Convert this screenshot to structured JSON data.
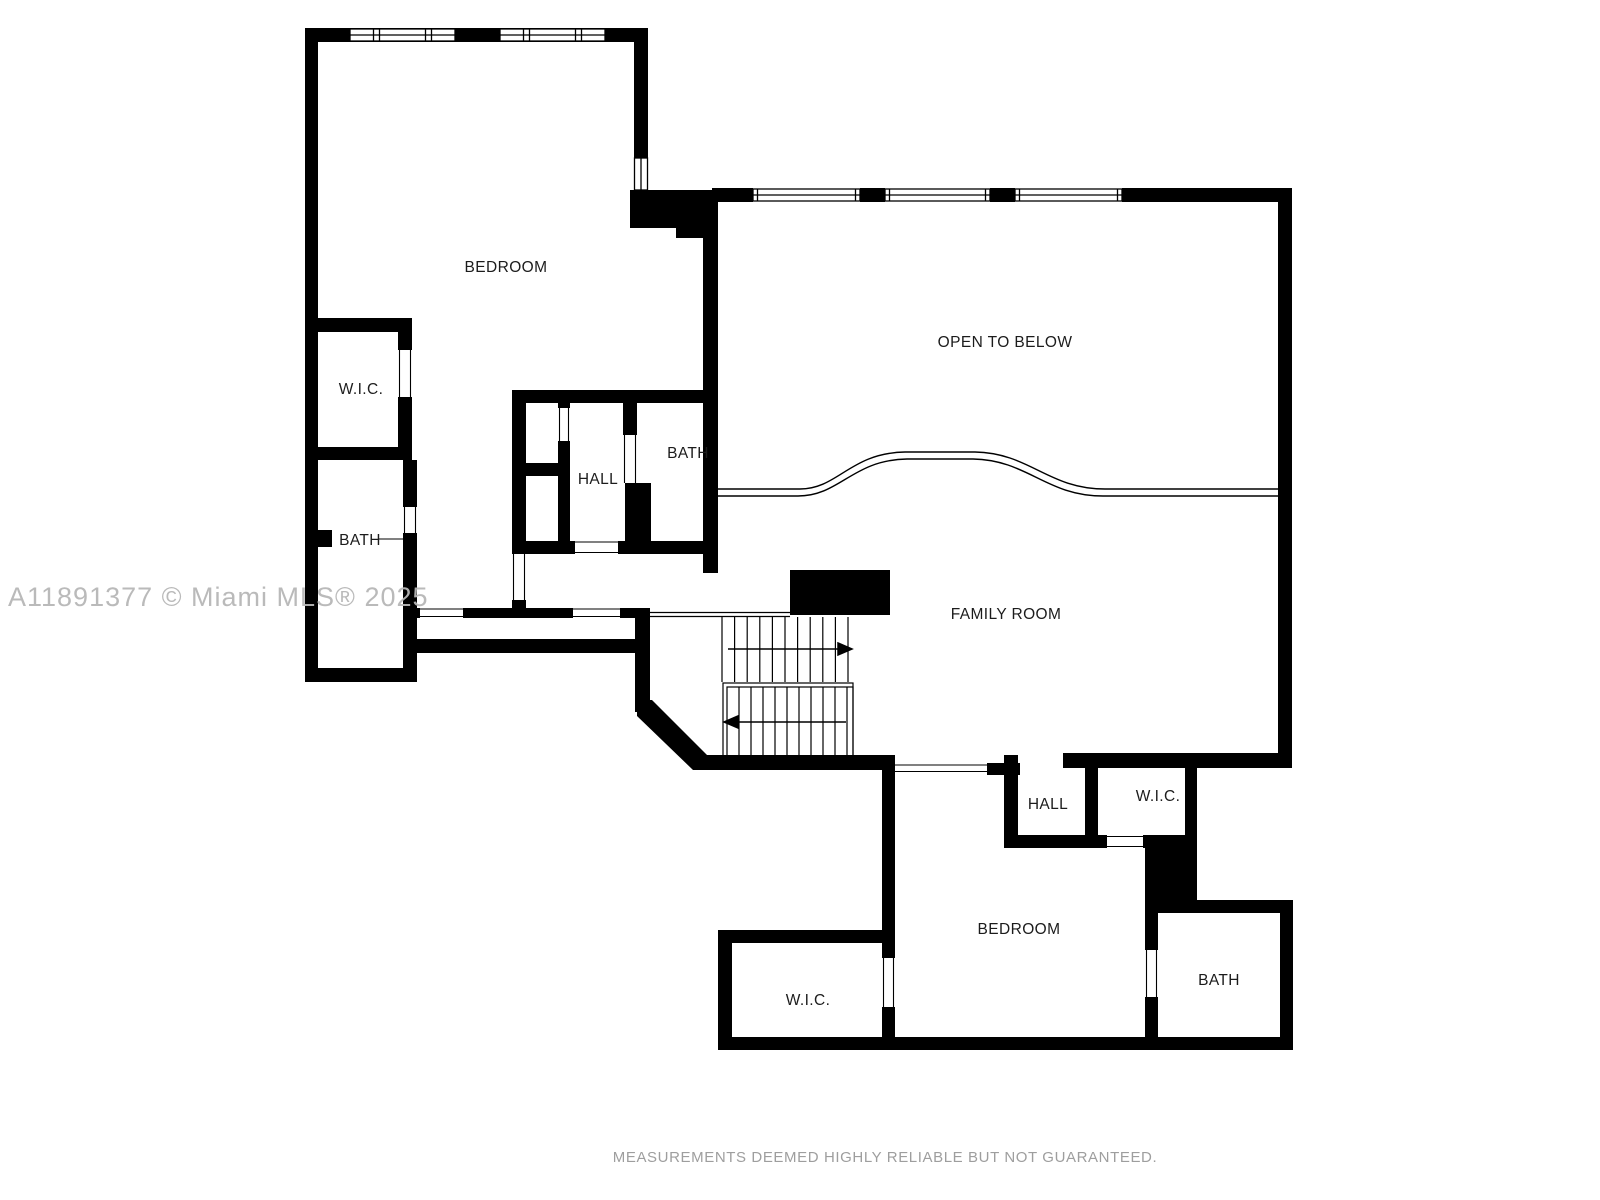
{
  "colors": {
    "wall": "#000000",
    "label": "#1c1c1c",
    "watermark": "#b7b7b7",
    "disclaimer": "#9e9e9e",
    "background": "#ffffff"
  },
  "watermark": {
    "text": "A11891377 © Miami MLS® 2025"
  },
  "disclaimer": {
    "text": "MEASUREMENTS DEEMED HIGHLY RELIABLE BUT NOT GUARANTEED."
  },
  "rooms": [
    {
      "id": "bedroom-upper",
      "label": "BEDROOM"
    },
    {
      "id": "wic-upper-left",
      "label": "W.I.C."
    },
    {
      "id": "bath-upper-left",
      "label": "BATH"
    },
    {
      "id": "hall-upper",
      "label": "HALL"
    },
    {
      "id": "bath-upper-mid",
      "label": "BATH"
    },
    {
      "id": "open-to-below",
      "label": "OPEN TO BELOW"
    },
    {
      "id": "family-room",
      "label": "FAMILY ROOM"
    },
    {
      "id": "hall-lower",
      "label": "HALL"
    },
    {
      "id": "wic-lower-right",
      "label": "W.I.C."
    },
    {
      "id": "bedroom-lower",
      "label": "BEDROOM"
    },
    {
      "id": "wic-lower-left",
      "label": "W.I.C."
    },
    {
      "id": "bath-lower-right",
      "label": "BATH"
    }
  ]
}
